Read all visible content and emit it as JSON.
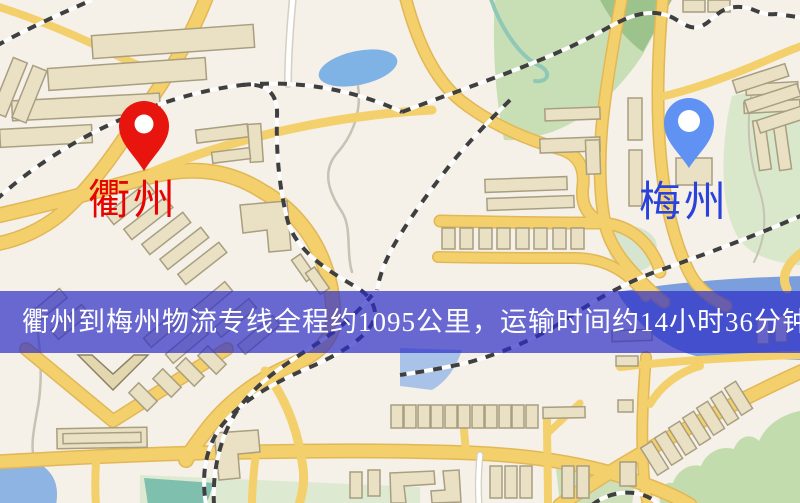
{
  "map": {
    "origin": {
      "name": "衢州",
      "pin_icon": "red-map-pin",
      "pin_color": "#e8150e",
      "label_color": "#e60400"
    },
    "destination": {
      "name": "梅州",
      "pin_icon": "blue-map-pin",
      "pin_color": "#5f92f2",
      "label_color": "#2a42da"
    },
    "banner": {
      "text": "衢州到梅州物流专线全程约1095公里，运输时间约14小时36分钟.",
      "background": "rgba(46,46,200,0.70)",
      "text_color": "#ffffff"
    },
    "route": {
      "distance_km": "1095",
      "transit_time": "14小时36分钟"
    }
  }
}
